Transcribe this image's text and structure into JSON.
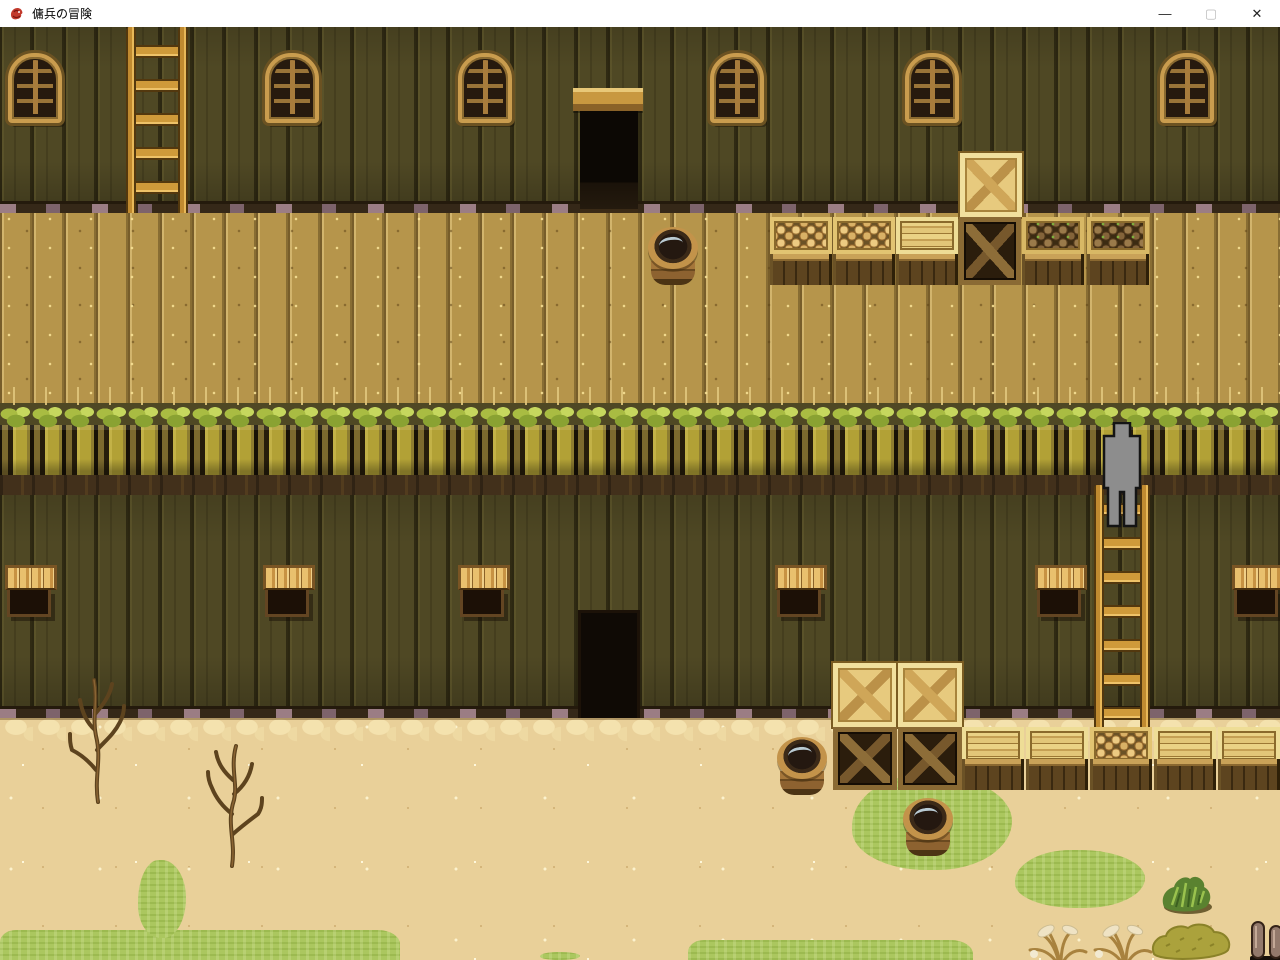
{
  "window": {
    "title": "傭兵の冒険",
    "app_icon": "dragon-icon",
    "controls": [
      {
        "id": "minimize",
        "glyph": "—",
        "enabled": true
      },
      {
        "id": "maximize",
        "glyph": "▢",
        "enabled": false
      },
      {
        "id": "close",
        "glyph": "✕",
        "enabled": true
      }
    ]
  },
  "game": {
    "view": "top-down pixel-art RPG map",
    "location": "large wooden warehouse exterior with upper walkway and sandy yard",
    "player": {
      "appearance": "gray placeholder silhouette sprite",
      "position": "standing on ladder at edge of upper walkway"
    },
    "objects": {
      "arched_windows": 6,
      "shuttered_windows": 6,
      "doorways": 2,
      "ladders": 2,
      "barrels": 3,
      "produce_crates": 5,
      "slatted_crates": 5,
      "x_crates_light": 3,
      "x_crates_dark": 3,
      "dead_bushes": 2,
      "green_bushes": 2,
      "flower_grass_plants": 2,
      "wooden_posts": 2
    },
    "palette": {
      "wall": "#4f4824",
      "walkway": "#b6954b",
      "ledge_posts": "#b2a136",
      "grass_tuft": "#a9bc42",
      "sand": "#e9d099",
      "grass_patch": "#abc75f",
      "crate_light": "#e7ca7e",
      "crate_dark": "#2b1d0c",
      "ladder": "#cf9a3a",
      "player": "#8d8d8d",
      "door_opening": "#0f0a05"
    }
  }
}
